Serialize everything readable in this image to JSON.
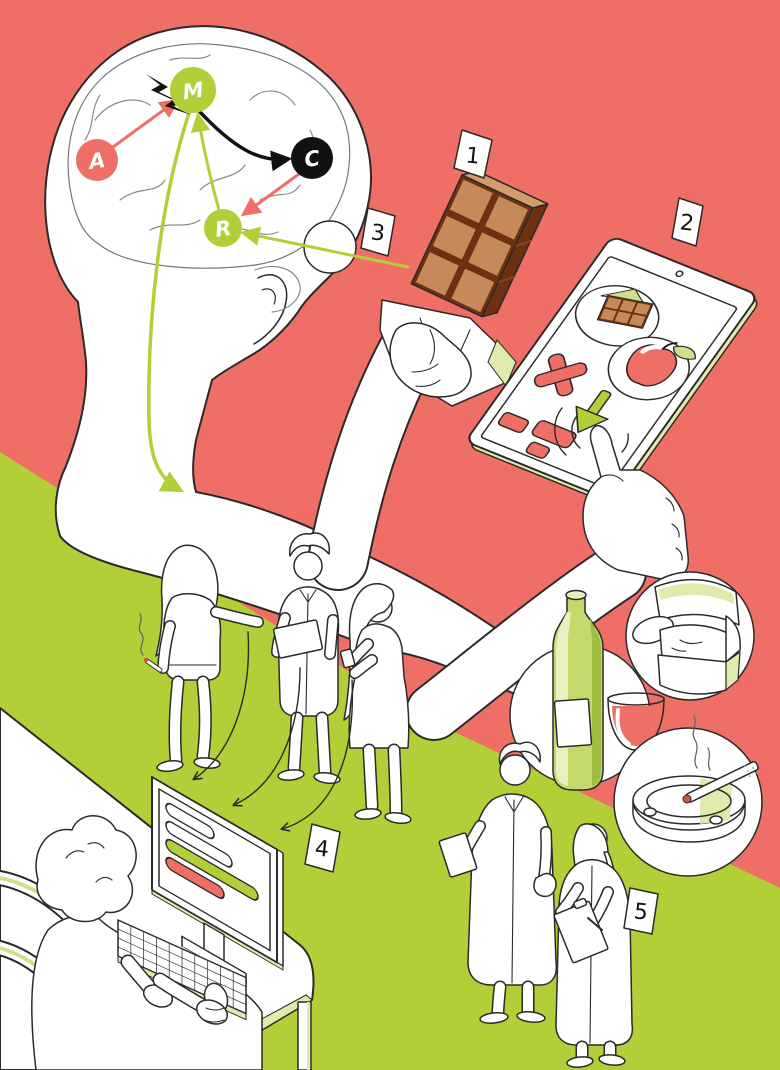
{
  "palette": {
    "coral": "#ef6f66",
    "green": "#b2cf37",
    "pale": "#e0eaad",
    "ink": "#2a2a2a",
    "black": "#111111",
    "white": "#ffffff",
    "brain_line": "#8a8a8a",
    "chocolate": "#c6895a",
    "chocolate_top": "#d49b6c",
    "chocolate_dark": "#6e3011",
    "bottle": "#c3d96c",
    "bottle_light": "#e8f0c0",
    "bottle_dark": "#9fbe3f",
    "leaf": "#cfe08c"
  },
  "brain": {
    "nodes": [
      {
        "id": "A",
        "label": "A",
        "color": "#ef6f66"
      },
      {
        "id": "M",
        "label": "M",
        "color": "#b2cf37"
      },
      {
        "id": "C",
        "label": "C",
        "color": "#111111"
      },
      {
        "id": "R",
        "label": "R",
        "color": "#b2cf37"
      }
    ],
    "spark": "lightning-bolt",
    "pathways": [
      {
        "from": "A",
        "to": "M",
        "color": "#ef6f66"
      },
      {
        "from": "M",
        "to": "C",
        "color": "#111111"
      },
      {
        "from": "C",
        "to": "R",
        "color": "#ef6f66"
      },
      {
        "from": "R",
        "to": "M",
        "color": "#b2cf37"
      },
      {
        "from": "cue-lens",
        "to": "R",
        "color": "#b2cf37"
      },
      {
        "from": "M",
        "to": "body",
        "color": "#b2cf37"
      }
    ]
  },
  "tags": [
    {
      "number": "1",
      "points_to": "chocolate-bar"
    },
    {
      "number": "2",
      "points_to": "tablet-choice-task"
    },
    {
      "number": "3",
      "points_to": "cue-lens"
    },
    {
      "number": "4",
      "points_to": "computer-data-entry"
    },
    {
      "number": "5",
      "points_to": "researchers"
    }
  ],
  "tablet": {
    "screen_items": [
      {
        "name": "chocolate-thumbnail"
      },
      {
        "name": "apple"
      }
    ],
    "reject_mark": "X",
    "choice_arrow": "down-arrow",
    "button_count": 3
  },
  "monitor": {
    "rows": [
      "text-field",
      "text-field",
      "green-bar",
      "red-bar"
    ]
  },
  "bubbles": [
    {
      "name": "armchair"
    },
    {
      "name": "wine-bottle-and-glass"
    },
    {
      "name": "cigarette-ashtray"
    }
  ],
  "figures": {
    "trio": [
      "woman-smoking",
      "man-with-clipboard",
      "woman-with-phone"
    ],
    "desk": "person-entering-data",
    "researchers": [
      "doctor-with-clipboard",
      "researcher-with-clipboard"
    ]
  }
}
